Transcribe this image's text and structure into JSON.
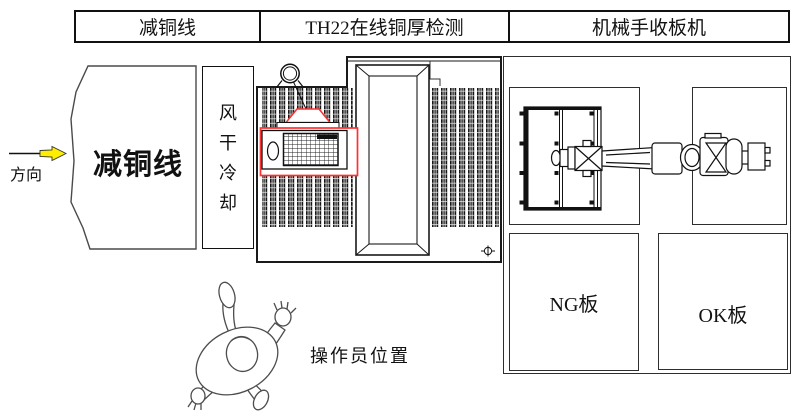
{
  "header": {
    "cells": [
      {
        "label": "减铜线"
      },
      {
        "label": "TH22在线铜厚检测"
      },
      {
        "label": "机械手收板机"
      }
    ]
  },
  "flow_arrow": {
    "label": "方向",
    "color": "#ffee00"
  },
  "upstream": {
    "label": "减铜线"
  },
  "cooling": {
    "label": "风干冷却",
    "chars": [
      "风",
      "干",
      "冷",
      "却"
    ]
  },
  "detector": {
    "accent_color": "#ff3030"
  },
  "collector": {
    "ng_label": "NG板",
    "ok_label": "OK板"
  },
  "operator": {
    "label": "操作员位置"
  },
  "colors": {
    "line": "#111111",
    "background": "#ffffff"
  }
}
